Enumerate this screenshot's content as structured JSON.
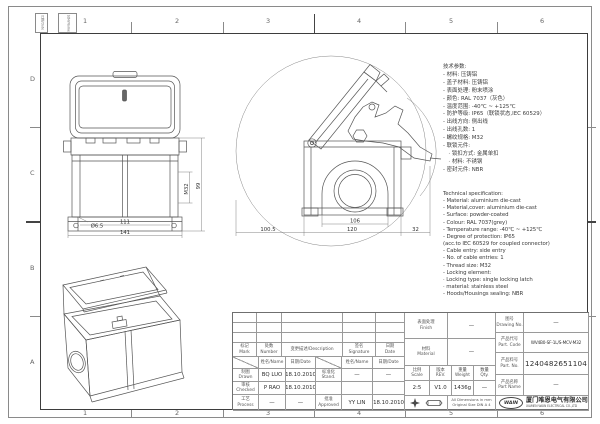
{
  "frame": {
    "top_numbers": [
      "1",
      "2",
      "3",
      "4",
      "5",
      "6"
    ],
    "bottom_numbers": [
      "1",
      "2",
      "3",
      "4",
      "5",
      "6"
    ],
    "left_letters": [
      "D",
      "C",
      "B",
      "A"
    ],
    "binding_box_1": "日期/Date",
    "binding_box_2": "姓名/Name"
  },
  "specs_cn": {
    "title": "技术参数:",
    "lines": [
      "- 材料: 压铸铝",
      "- 盖子材料: 压铸铝",
      "- 表面处理: 粉末喷涂",
      "- 颜色: RAL 7037（灰色）",
      "- 温度范围: -40℃ ~ +125℃",
      "- 防护等级: IP65（联锁状态,IEC 60529）",
      "- 出线方向: 侧出线",
      "- 出线孔数: 1",
      "- 螺纹规格: M32",
      "- 联锁元件:",
      "　· 锁扣方式: 金属单扣",
      "　· 材料: 不锈钢",
      "- 密封元件: NBR"
    ]
  },
  "specs_en": {
    "title": "Technical specification:",
    "lines": [
      "- Material: aluminium die-cast",
      "- Material,cover: aluminium die-cast",
      "- Surface: powder-coated",
      "- Colour: RAL 7037(grey)",
      "- Temperature range: -40℃ ~ +125℃",
      "- Degree of protection: IP65",
      "  (acc.to IEC 60529 for coupled connector)",
      "- Cable entry: side entry",
      "- No. of cable entries: 1",
      "- Thread size: M32",
      "- Locking element:",
      "   · Locking type: single locking latch",
      "   · material: stainless steel",
      "- Hoods/Housings sealing: NBR"
    ]
  },
  "views": {
    "front": {
      "width_outer": "141",
      "width_inner": "111",
      "height": "99",
      "hole": "Ø6.5",
      "thread": "M32"
    },
    "side": {
      "inner_width": "106",
      "outer_width": "120",
      "offset_left": "100.5",
      "offset_right": "32"
    }
  },
  "title_block": {
    "revision": {
      "mark": "标记\nMark",
      "number": "处数\nNumber",
      "description": "变更描述/Description",
      "signature": "签名\nSignature",
      "date": "日期\nDate",
      "name_hdr1": "姓名/Name",
      "date_hdr1": "日期/Date",
      "name_hdr2": "姓名/Name",
      "date_hdr2": "日期/Date"
    },
    "sign": {
      "drawn_label": "制图\nDrawn",
      "drawn_name": "BQ LUO",
      "drawn_date": "18.10.2010",
      "checked_label": "审核\nChecked",
      "checked_name": "P RAO",
      "checked_date": "18.10.2010",
      "process_label": "工艺\nProcess",
      "process_name": "—",
      "process_date": "—",
      "stand_label": "标准化\nStand.",
      "stand_name": "—",
      "stand_date": "—",
      "approved_label": "批准\nApproved",
      "approved_name": "YY LIN",
      "approved_date": "18.10.2010"
    },
    "info": {
      "finish_label": "表面处理\nFinish",
      "finish_value": "—",
      "material_label": "材料\nMaterial",
      "material_value": "—",
      "scale_label": "比例\nScale",
      "scale_value": "2:5",
      "rev_label": "版本\nREV.",
      "rev_value": "V1.0",
      "weight_label": "重量\nWeight",
      "weight_value": "1436g",
      "qty_label": "数量\nQty.",
      "qty_value": "—",
      "drawing_no_label": "图号\nDrawing No.",
      "drawing_no_value": "—",
      "part_code_label": "产品代号\nPart. Code",
      "part_code_value": "WV4B0-SF-1L/S-MCV-M32",
      "part_no_label": "产品料号\nPart. No.",
      "part_no_value": "1240482651104",
      "part_name_label": "产品名称\nPart Name",
      "part_name_value": "—"
    },
    "footer": {
      "note_line1": "All Dimensions in mm",
      "note_line2": "Original Size DIN A 4",
      "logo": "WAIN",
      "company_cn": "厦门唯恩电气有限公司",
      "company_en": "XIAMEN WAIN ELECTRICAL CO.,LTD"
    }
  },
  "colors": {
    "line": "#555555",
    "dim": "#666666",
    "frame": "#3d3d3d"
  }
}
